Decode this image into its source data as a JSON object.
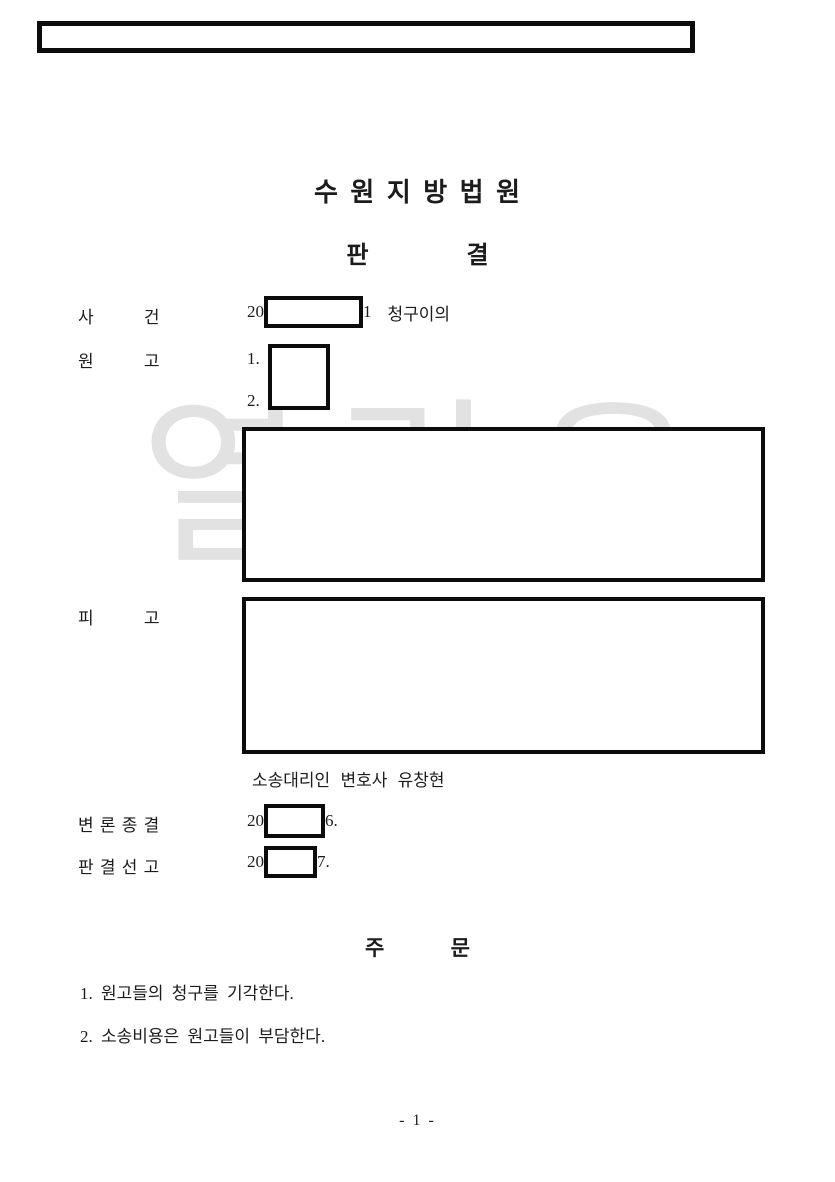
{
  "page": {
    "watermark": "열람용",
    "page_number": "- 1 -"
  },
  "court": {
    "name": "수 원 지 방 법 원",
    "doc_type": "판 결"
  },
  "case_info": {
    "case": {
      "label": "사 건",
      "year_prefix": "20",
      "number_suffix": "1",
      "case_type": "청구이의"
    },
    "plaintiff": {
      "label": "원 고",
      "item1": "1.",
      "item2": "2."
    },
    "defendant": {
      "label": "피 고",
      "counsel": "소송대리인 변호사 유창현"
    },
    "hearing_closed": {
      "label": "변 론 종 결",
      "year_prefix": "20",
      "suffix": "6."
    },
    "judgment_date": {
      "label": "판 결 선 고",
      "year_prefix": "20",
      "suffix": "7."
    }
  },
  "order": {
    "header": "주 문",
    "items": [
      "1. 원고들의 청구를 기각한다.",
      "2. 소송비용은 원고들이 부담한다."
    ]
  }
}
